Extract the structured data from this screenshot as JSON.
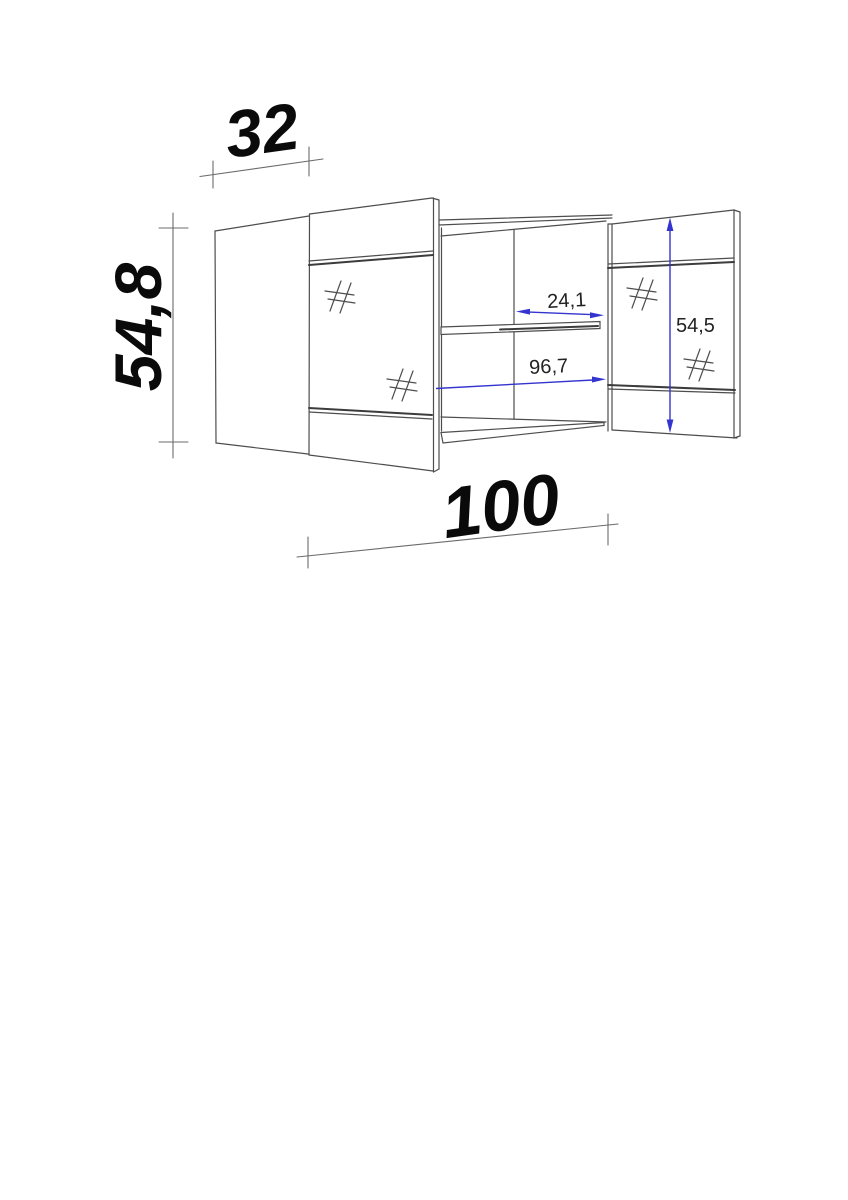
{
  "drawing": {
    "kind": "furniture-dimension-drawing",
    "dimensions": {
      "depth": "32",
      "height": "54,8",
      "width": "100",
      "inner_width": "96,7",
      "compartment_width": "24,1",
      "door_height": "54,5"
    },
    "colors": {
      "annotation_blue": "#3434cf",
      "line_gray": "#4d4d4d",
      "text_black": "#0a0a0a"
    }
  }
}
